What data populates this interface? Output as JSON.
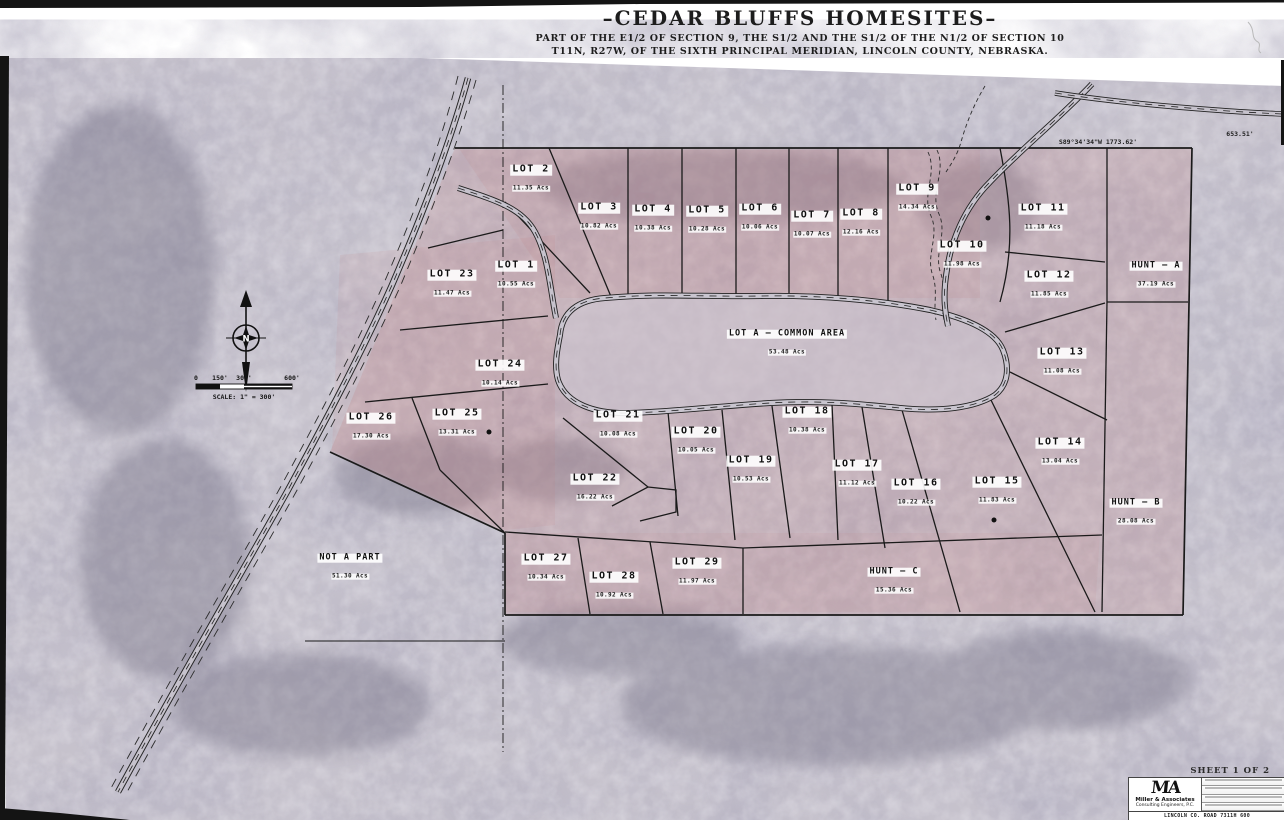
{
  "title": {
    "main": "–CEDAR BLUFFS HOMESITES–",
    "sub1": "PART OF THE E1/2 OF SECTION 9, THE S1/2 AND THE S1/2 OF THE N1/2 OF SECTION 10",
    "sub2": "T11N, R27W, OF THE SIXTH PRINCIPAL MERIDIAN, LINCOLN COUNTY, NEBRASKA."
  },
  "map": {
    "lots": [
      {
        "id": "lot-1",
        "name": "LOT 1",
        "acres": "10.55 Acs",
        "x": 516,
        "y": 272
      },
      {
        "id": "lot-2",
        "name": "LOT 2",
        "acres": "11.35 Acs",
        "x": 531,
        "y": 176
      },
      {
        "id": "lot-3",
        "name": "LOT 3",
        "acres": "10.82 Acs",
        "x": 599,
        "y": 214
      },
      {
        "id": "lot-4",
        "name": "LOT 4",
        "acres": "10.38 Acs",
        "x": 653,
        "y": 216
      },
      {
        "id": "lot-5",
        "name": "LOT 5",
        "acres": "10.28 Acs",
        "x": 707,
        "y": 217
      },
      {
        "id": "lot-6",
        "name": "LOT 6",
        "acres": "10.06 Acs",
        "x": 760,
        "y": 215
      },
      {
        "id": "lot-7",
        "name": "LOT 7",
        "acres": "10.07 Acs",
        "x": 812,
        "y": 222
      },
      {
        "id": "lot-8",
        "name": "LOT 8",
        "acres": "12.16 Acs",
        "x": 861,
        "y": 220
      },
      {
        "id": "lot-9",
        "name": "LOT 9",
        "acres": "14.34 Acs",
        "x": 917,
        "y": 195
      },
      {
        "id": "lot-10",
        "name": "LOT 10",
        "acres": "11.98 Acs",
        "x": 962,
        "y": 252
      },
      {
        "id": "lot-11",
        "name": "LOT 11",
        "acres": "11.18 Acs",
        "x": 1043,
        "y": 215
      },
      {
        "id": "lot-12",
        "name": "LOT 12",
        "acres": "11.85 Acs",
        "x": 1049,
        "y": 282
      },
      {
        "id": "lot-13",
        "name": "LOT 13",
        "acres": "11.08 Acs",
        "x": 1062,
        "y": 359
      },
      {
        "id": "lot-14",
        "name": "LOT 14",
        "acres": "13.04 Acs",
        "x": 1060,
        "y": 449
      },
      {
        "id": "lot-15",
        "name": "LOT 15",
        "acres": "11.83 Acs",
        "x": 997,
        "y": 488
      },
      {
        "id": "lot-16",
        "name": "LOT 16",
        "acres": "10.22 Acs",
        "x": 916,
        "y": 490
      },
      {
        "id": "lot-17",
        "name": "LOT 17",
        "acres": "11.12 Acs",
        "x": 857,
        "y": 471
      },
      {
        "id": "lot-18",
        "name": "LOT 18",
        "acres": "10.38 Acs",
        "x": 807,
        "y": 418
      },
      {
        "id": "lot-19",
        "name": "LOT 19",
        "acres": "10.53 Acs",
        "x": 751,
        "y": 467
      },
      {
        "id": "lot-20",
        "name": "LOT 20",
        "acres": "10.05 Acs",
        "x": 696,
        "y": 438
      },
      {
        "id": "lot-21",
        "name": "LOT 21",
        "acres": "10.08 Acs",
        "x": 618,
        "y": 422
      },
      {
        "id": "lot-22",
        "name": "LOT 22",
        "acres": "16.22 Acs",
        "x": 595,
        "y": 485
      },
      {
        "id": "lot-23",
        "name": "LOT 23",
        "acres": "11.47 Acs",
        "x": 452,
        "y": 281
      },
      {
        "id": "lot-24",
        "name": "LOT 24",
        "acres": "10.14 Acs",
        "x": 500,
        "y": 371
      },
      {
        "id": "lot-25",
        "name": "LOT 25",
        "acres": "13.31 Acs",
        "x": 457,
        "y": 420
      },
      {
        "id": "lot-26",
        "name": "LOT 26",
        "acres": "17.30 Acs",
        "x": 371,
        "y": 424
      },
      {
        "id": "lot-27",
        "name": "LOT 27",
        "acres": "10.34 Acs",
        "x": 546,
        "y": 565
      },
      {
        "id": "lot-28",
        "name": "LOT 28",
        "acres": "10.92 Acs",
        "x": 614,
        "y": 583
      },
      {
        "id": "lot-29",
        "name": "LOT 29",
        "acres": "11.97 Acs",
        "x": 697,
        "y": 569
      },
      {
        "id": "lot-a-common-area",
        "name": "LOT A – COMMON AREA",
        "acres": "53.48 Acs",
        "x": 787,
        "y": 340,
        "size": "sm"
      },
      {
        "id": "hunt-a",
        "name": "HUNT – A",
        "acres": "37.19 Acs",
        "x": 1156,
        "y": 272,
        "size": "sm"
      },
      {
        "id": "hunt-b",
        "name": "HUNT – B",
        "acres": "28.08 Acs",
        "x": 1136,
        "y": 509,
        "size": "sm"
      },
      {
        "id": "hunt-c",
        "name": "HUNT – C",
        "acres": "15.36 Acs",
        "x": 894,
        "y": 578,
        "size": "sm"
      },
      {
        "id": "not-a-part",
        "name": "NOT A PART",
        "acres": "51.30 Acs",
        "x": 350,
        "y": 564,
        "size": "sm"
      }
    ],
    "survey_dots": [
      {
        "x": 988,
        "y": 218
      },
      {
        "x": 489,
        "y": 432
      },
      {
        "x": 994,
        "y": 520
      }
    ],
    "annotations": {
      "bearing_top_right": "S89°34'34\"W   1773.62'",
      "distance_right": "653.51'",
      "compass_letter": "N",
      "scale_ticks": [
        "0",
        "150'",
        "300'",
        "600'"
      ],
      "scale_label": "SCALE: 1\" = 300'"
    }
  },
  "title_block": {
    "sheet_label": "SHEET 1 OF 2",
    "logo_text": "MA",
    "firm_name": "Miller & Associates",
    "firm_subtitle": "Consulting Engineers, P.C.",
    "project_label": "LINCOLN CO. ROAD 7311H 600"
  },
  "colors": {
    "photo_base": "#c6c2cc",
    "plat_tint": "#c47878",
    "line": "#1a1a1a",
    "scan_edge": "#141414"
  }
}
